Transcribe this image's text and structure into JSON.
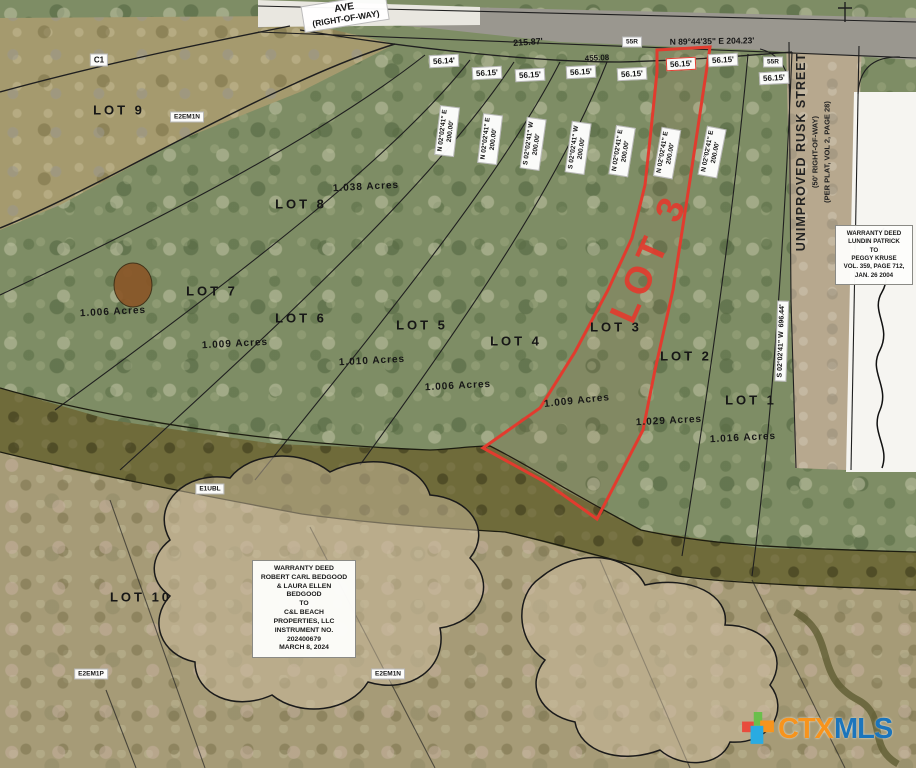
{
  "road": {
    "street_label_line1": "AVE",
    "street_label_line2": "(RIGHT-OF-WAY)",
    "curve_label": "C1",
    "dim_a": "215.87'",
    "dim_b": "455.08",
    "bearing": "N 89°44'35\" E  204.23'",
    "station_a": "55R",
    "station_b": "55R"
  },
  "rusk_street": {
    "name": "UNIMPROVED RUSK STREET",
    "right_of_way": "(50' RIGHT-OF-WAY)",
    "plat_note": "(PER PLAT, VOL 2, PAGE 28)"
  },
  "east_boundary": {
    "bearing": "S 02°02'41\" W",
    "distance": "696.44'"
  },
  "frontages": [
    "56.14'",
    "56.15'",
    "56.15'",
    "56.15'",
    "56.15'",
    "56.15'",
    "56.15'",
    "56.15'"
  ],
  "side_bearings": [
    {
      "dir": "N 02°02'41\" E",
      "dist": "200.00'"
    },
    {
      "dir": "N 02°02'41\" E",
      "dist": "200.00'"
    },
    {
      "dir": "S 02°02'41\" W",
      "dist": "200.00'"
    },
    {
      "dir": "S 02°02'41\" W",
      "dist": "200.00'"
    },
    {
      "dir": "N 02°02'41\" E",
      "dist": "200.00'"
    },
    {
      "dir": "N 02°02'41\" E",
      "dist": "200.00'"
    },
    {
      "dir": "N 02°02'41\" E",
      "dist": "200.00'"
    }
  ],
  "lots": [
    {
      "name": "LOT 9"
    },
    {
      "name": "LOT 8",
      "acres": "1.038 Acres"
    },
    {
      "name": "LOT 7",
      "acres": "1.006 Acres"
    },
    {
      "name": "LOT 6",
      "acres": "1.009 Acres"
    },
    {
      "name": "LOT 5",
      "acres": "1.010 Acres"
    },
    {
      "name": "LOT 4",
      "acres": "1.006 Acres"
    },
    {
      "name": "LOT 3",
      "acres": "1.009 Acres"
    },
    {
      "name": "LOT 2",
      "acres": "1.029 Acres"
    },
    {
      "name": "LOT 1",
      "acres": "1.016 Acres"
    },
    {
      "name": "LOT 10"
    }
  ],
  "highlight": {
    "label": "LOT 3",
    "color": "#e23b2e"
  },
  "wetland_codes": {
    "top": "E2EM1N",
    "middle": "E1UBL",
    "bottom_left": "E2EM1P",
    "bottom_center": "E2EM1N"
  },
  "deed_center": {
    "lines": [
      "WARRANTY DEED",
      "ROBERT CARL BEDGOOD",
      "& LAURA ELLEN",
      "BEDGOOD",
      "TO",
      "C&L BEACH",
      "PROPERTIES, LLC",
      "INSTRUMENT NO.",
      "202400679",
      "MARCH 8, 2024"
    ]
  },
  "deed_right": {
    "lines": [
      "WARRANTY DEED",
      "LUNDIN PATRICK",
      "TO",
      "PEGGY KRUSE",
      "VOL. 359, PAGE 712,",
      "JAN. 26 2004"
    ]
  },
  "logo": {
    "ctx": "CTX",
    "mls": "MLS",
    "ctx_color": "#f7941d",
    "mls_color": "#1b75bc"
  }
}
